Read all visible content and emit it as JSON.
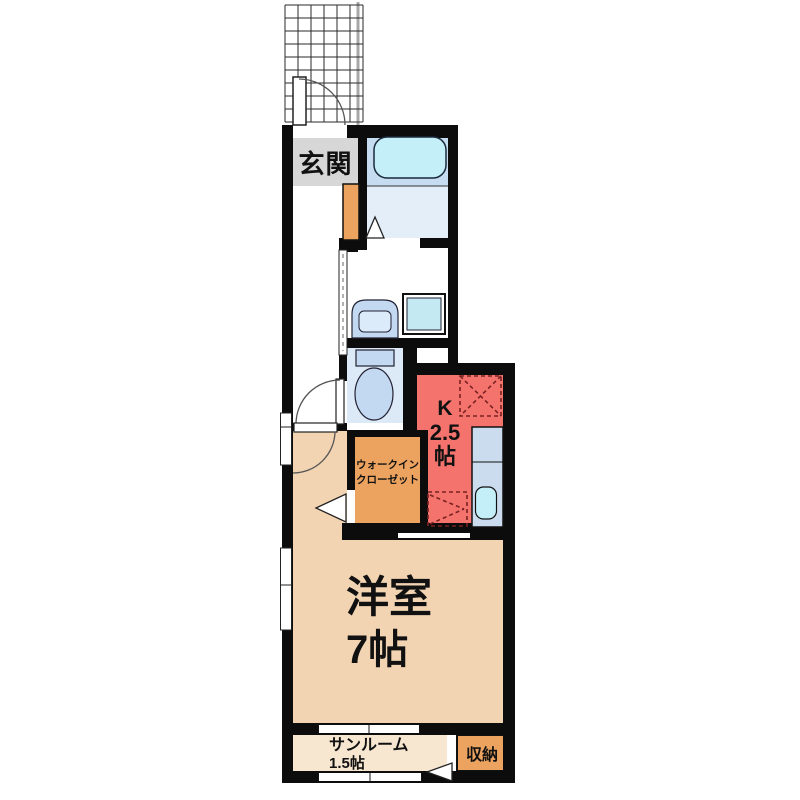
{
  "plan_title": "one-room apartment floor plan",
  "labels": {
    "genkan": "玄関",
    "kitchen_k": "K",
    "kitchen_size": "2.5",
    "kitchen_unit": "帖",
    "wic_line1": "ウォークイン",
    "wic_line2": "クローゼット",
    "main_room": "洋室",
    "main_size": "7帖",
    "sunroom": "サンルーム",
    "sunroom_size": "1.5帖",
    "storage": "収納"
  },
  "colors": {
    "wall": "#0c0c0c",
    "kitchen_floor": "#f5736d",
    "main_room_floor": "#f2d3b2",
    "sunroom_floor": "#f8e7d0",
    "closet_orange": "#eca360",
    "entrance_gray": "#d7d7d7",
    "bath_upper_floor": "#c6dcf0",
    "bath_lower_floor": "#e4eef8",
    "toilet_floor": "#dce9f7",
    "bathtub_cyan": "#c4eff9",
    "fixture_blue": "#c3d8f1",
    "counter_blue": "#ccdcef",
    "dashed_marker": "#7a2222"
  }
}
